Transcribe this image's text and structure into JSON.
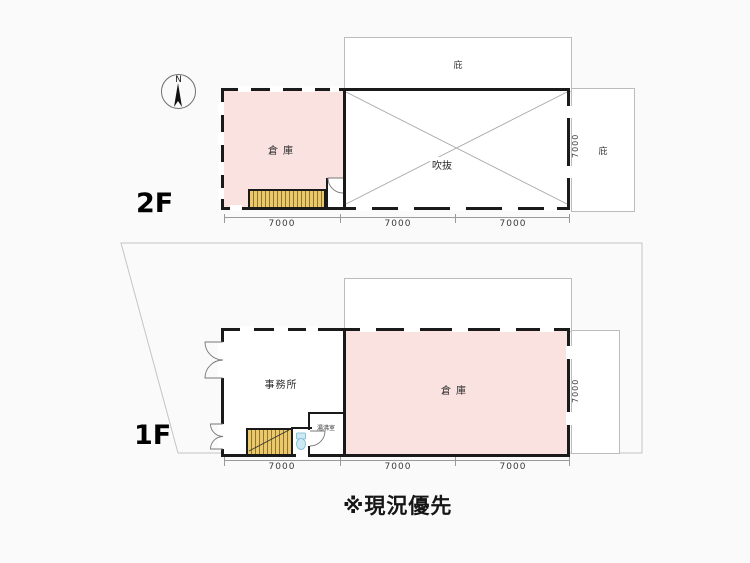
{
  "compass": {
    "north_label": "N"
  },
  "floor_2f": {
    "label": "2F",
    "canopy_top_label": "庇",
    "canopy_right_label": "庇",
    "rooms": {
      "warehouse": "倉庫",
      "void": "吹抜"
    },
    "dims_bottom": [
      "7000",
      "7000",
      "7000"
    ],
    "dim_right": "7000"
  },
  "floor_1f": {
    "label": "1F",
    "rooms": {
      "office": "事務所",
      "warehouse": "倉庫",
      "kitchenette": "湯沸室"
    },
    "dims_bottom": [
      "7000",
      "7000",
      "7000"
    ],
    "dim_right": "7000"
  },
  "caption": "※現況優先",
  "colors": {
    "room_fill_pink": "#f9e2e0",
    "stairs_yellow": "#ebc96a",
    "wall_black": "#1a1a1a",
    "boundary_gray": "#c4c4c4",
    "toilet_blue": "#cdeaf4"
  }
}
